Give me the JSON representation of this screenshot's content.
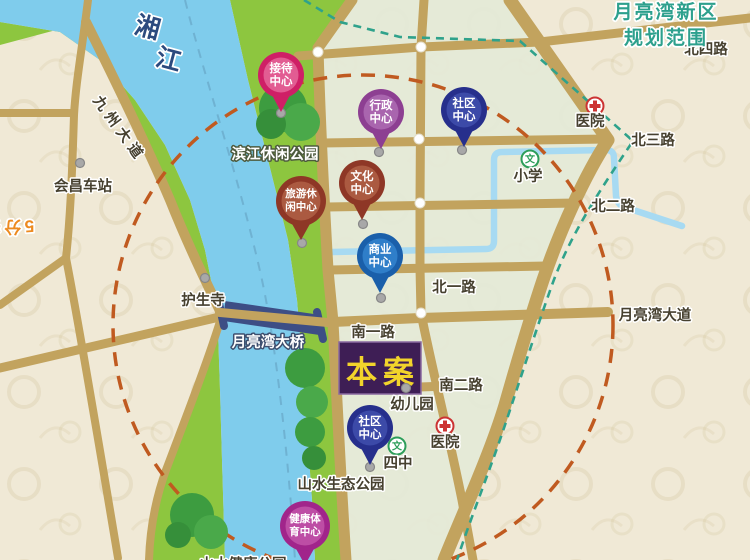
{
  "map": {
    "title_note": {
      "line1": "月亮湾新区",
      "line2": "规划范围"
    },
    "river_name": {
      "char1": "湘",
      "char2": "江"
    },
    "life_circle": {
      "top": "5分钟生活圈",
      "right": "5分钟生活圈"
    },
    "project": {
      "label": "本案"
    },
    "roads": {
      "jiuzhou_avenue": "九州大道",
      "north4": "北四路",
      "north3": "北三路",
      "north2": "北二路",
      "north1": "北一路",
      "south1": "南一路",
      "south2": "南二路",
      "moonbay_avenue": "月亮湾大道",
      "moonbay_bridge": "月亮湾大桥"
    },
    "places": {
      "huichang_station": "会昌车站",
      "binjiang_leisure_park": "滨江休闲公园",
      "husheng_temple": "护生寺",
      "hospital_north": "医院",
      "primary_school": "小学",
      "kindergarten": "幼儿园",
      "hospital_south": "医院",
      "no4_middle_school": "四中",
      "shanshui_eco_park": "山水生态公园",
      "shanshui_health_park": "山水健康公园"
    },
    "pins": [
      {
        "name": "reception-center",
        "line1": "接待",
        "line2": "中心",
        "ring": "#cf1f66",
        "disc": "#e25c92"
      },
      {
        "name": "admin-center",
        "line1": "行政",
        "line2": "中心",
        "ring": "#8d3f92",
        "disc": "#a965ae"
      },
      {
        "name": "community-center-north",
        "line1": "社区",
        "line2": "中心",
        "ring": "#262f8c",
        "disc": "#3c4aa8"
      },
      {
        "name": "culture-center",
        "line1": "文化",
        "line2": "中心",
        "ring": "#8e3726",
        "disc": "#ab5a41"
      },
      {
        "name": "tourism-leisure-center",
        "line1": "旅游休",
        "line2": "闲中心",
        "ring": "#8e3726",
        "disc": "#ab5a41"
      },
      {
        "name": "business-center",
        "line1": "商业",
        "line2": "中心",
        "ring": "#1a5faa",
        "disc": "#2f7ec9"
      },
      {
        "name": "community-center-south",
        "line1": "社区",
        "line2": "中心",
        "ring": "#262f8c",
        "disc": "#3c4aa8"
      },
      {
        "name": "health-sports-center",
        "line1": "健康体",
        "line2": "育中心",
        "ring": "#a1258b",
        "disc": "#bd4da5"
      }
    ],
    "colors": {
      "paper": "#f0e9d6",
      "planning_block": "#e4e9d7",
      "road": "#c2a35e",
      "river": "#7fccec",
      "river_bank": "#8dc63f",
      "tree": "#3d9c40",
      "life_circle_ring": "#c05a20",
      "life_circle_text": "#ed8a1f",
      "boundary_dash": "#2fa28b",
      "boundary_text": "#2da08d",
      "project_box_bg": "#3e1e55",
      "project_box_text": "#f2d42b",
      "bridge": "#3d4e85",
      "hospital_red": "#cc3333",
      "school_green": "#2d9e5a"
    }
  }
}
